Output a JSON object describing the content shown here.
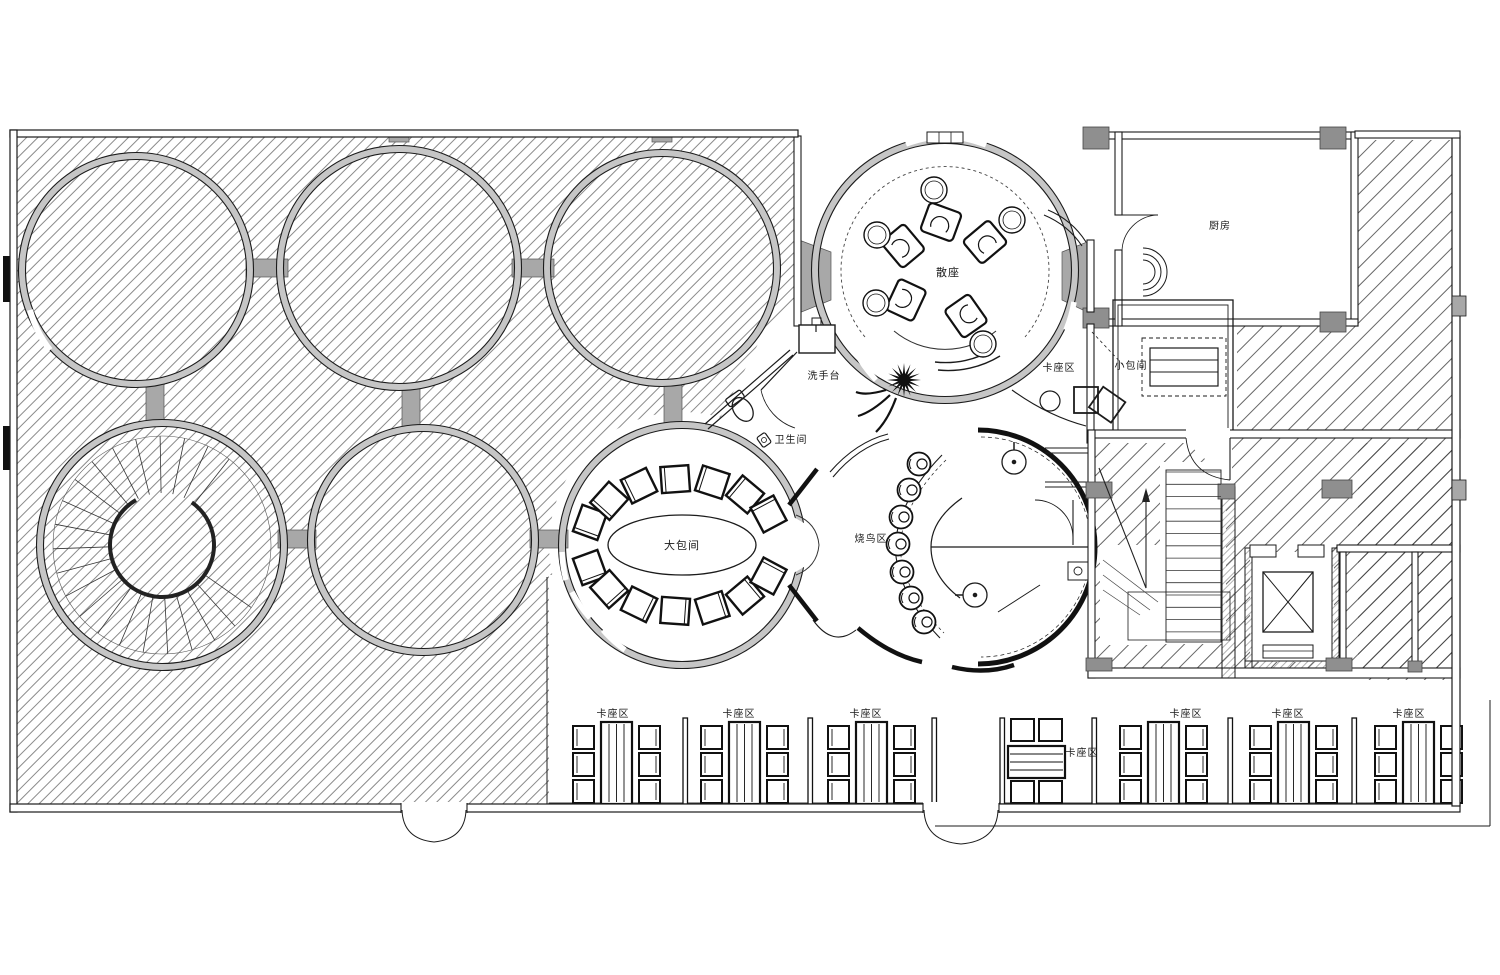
{
  "labels": {
    "large_private_room": "大包间",
    "open_seating": "散座",
    "grill_bar_area": "烧鸟区",
    "wash_station": "洗手台",
    "restroom": "卫生间",
    "booth_area": "卡座区",
    "small_private_room": "小包间",
    "kitchen": "厨房"
  },
  "colors": {
    "line": "#1b1b1b",
    "poche_gray": "#a8a8a8",
    "ring_gray": "#c6c6c6",
    "hatch": "#4a4a4a",
    "paper": "#ffffff"
  }
}
